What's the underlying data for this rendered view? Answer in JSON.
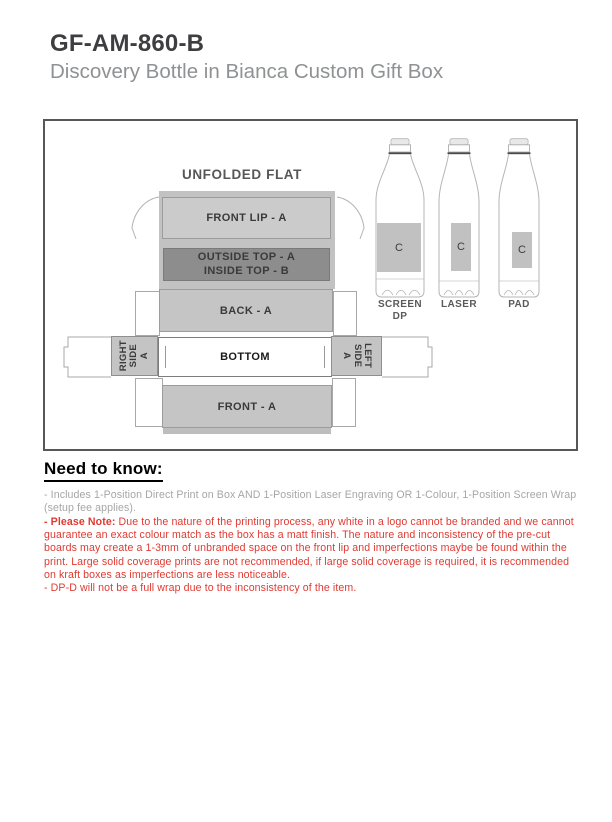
{
  "header": {
    "sku": "GF-AM-860-B",
    "product_name": "Discovery Bottle in Bianca Custom Gift Box"
  },
  "diagram": {
    "title": "UNFOLDED FLAT",
    "panels": {
      "front_lip": "FRONT LIP - A",
      "outside_top": "OUTSIDE TOP - A",
      "inside_top": "INSIDE TOP - B",
      "back": "BACK - A",
      "bottom": "BOTTOM",
      "front": "FRONT - A",
      "right_side": {
        "l1": "RIGHT",
        "l2": "SIDE",
        "l3": "A"
      },
      "left_side": {
        "l1": "LEFT",
        "l2": "SIDE",
        "l3": "A"
      }
    },
    "bottles": [
      {
        "method_line1": "SCREEN",
        "method_line2": "DP",
        "code": "C"
      },
      {
        "method_line1": "LASER",
        "method_line2": "",
        "code": "C"
      },
      {
        "method_line1": "PAD",
        "method_line2": "",
        "code": "C"
      }
    ]
  },
  "need_to_know": {
    "heading": "Need to know:",
    "items": [
      {
        "text": "- Includes 1-Position Direct Print on Box AND 1-Position Laser Engraving OR 1-Colour, 1-Position Screen Wrap (setup fee applies)."
      },
      {
        "bold": "- Please Note:",
        "text": " Due to the nature of the printing process, any white in a logo cannot be branded and we cannot guarantee an exact colour match as the box has a matt finish. The nature and inconsistency of the pre-cut boards may create a 1-3mm of unbranded space on the front lip and imperfections maybe be found within the print. Large solid coverage prints are not recommended, if large solid coverage is required, it is recommended on kraft boxes as imperfections are less noticeable."
      },
      {
        "text": "- DP-D will not be a full wrap due to the inconsistency of the item."
      }
    ]
  },
  "colors": {
    "note_red": "#e03a32",
    "muted_text": "#a6a6a6",
    "panel_light": "#c6c6c6",
    "panel_dark": "#8d8d8d",
    "heading_text": "#3e3e40",
    "subtitle_gray": "#8f9193"
  }
}
